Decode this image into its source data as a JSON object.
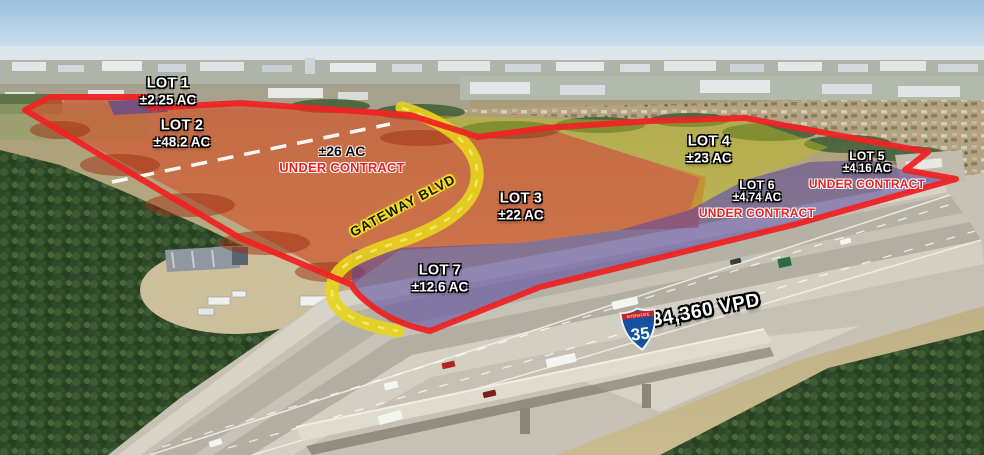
{
  "scene": {
    "type": "aerial-lot-site-plan"
  },
  "lots": [
    {
      "name": "LOT 1",
      "acreage": "±2.25 AC",
      "status": ""
    },
    {
      "name": "LOT 2",
      "acreage": "±48.2 AC",
      "status": ""
    },
    {
      "name": "",
      "acreage": "±26 AC",
      "status": "UNDER CONTRACT"
    },
    {
      "name": "LOT 3",
      "acreage": "±22 AC",
      "status": ""
    },
    {
      "name": "LOT 4",
      "acreage": "±23 AC",
      "status": ""
    },
    {
      "name": "LOT 5",
      "acreage": "±4.16 AC",
      "status": "UNDER CONTRACT"
    },
    {
      "name": "LOT 6",
      "acreage": "±4.74 AC",
      "status": "UNDER CONTRACT"
    },
    {
      "name": "LOT 7",
      "acreage": "±12.6 AC",
      "status": ""
    }
  ],
  "road": {
    "label": "GATEWAY BLVD"
  },
  "highway": {
    "shield_caption": "INTERSTATE",
    "shield_number": "35",
    "traffic_count": "84,360 VPD"
  },
  "colors": {
    "boundary_red": "#ee2424",
    "overlay_orange": "#d84820",
    "overlay_purple": "#5846a0",
    "overlay_blue_lot1": "#4840a8",
    "overlay_yellow_green": "#bebe1e",
    "road_yellow": "#e8d41e",
    "under_contract_red": "#e62222",
    "divider_white": "#ffffff"
  }
}
